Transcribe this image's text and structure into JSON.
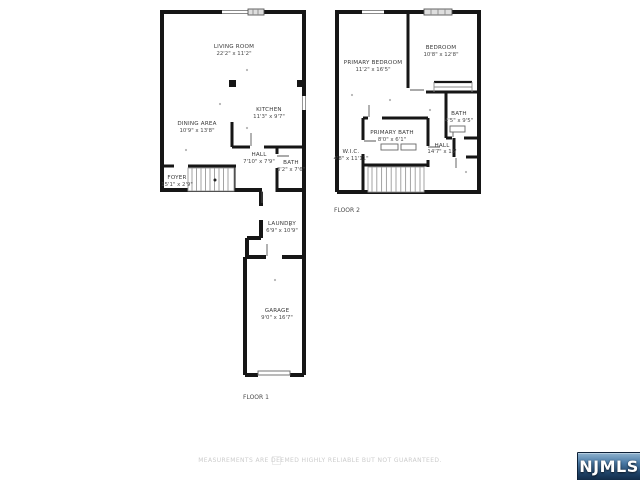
{
  "page": {
    "background": "#ffffff"
  },
  "colors": {
    "wall": "#161616",
    "window_fill": "#dedede",
    "label_text": "#3a3a3a",
    "disclaimer_text": "#cccccc",
    "logo_top": "#8fb3cf",
    "logo_bottom": "#122c49",
    "logo_text": "#ffffff"
  },
  "disclaimer": "MEASUREMENTS ARE DEEMED HIGHLY RELIABLE BUT NOT GUARANTEED.",
  "logo": {
    "text": "NJMLS"
  },
  "floor1": {
    "label": "FLOOR 1",
    "rooms": [
      {
        "name": "LIVING ROOM",
        "dims": "22'2\" x 11'2\""
      },
      {
        "name": "KITCHEN",
        "dims": "11'3\" x 9'7\""
      },
      {
        "name": "DINING AREA",
        "dims": "10'9\" x 13'8\""
      },
      {
        "name": "HALL",
        "dims": "7'10\" x 7'9\""
      },
      {
        "name": "BATH",
        "dims": "3'2\" x 7'6\""
      },
      {
        "name": "FOYER",
        "dims": "15'1\" x 2'9\""
      },
      {
        "name": "LAUNDRY",
        "dims": "6'9\" x 10'9\""
      },
      {
        "name": "GARAGE",
        "dims": "9'0\" x 16'7\""
      }
    ]
  },
  "floor2": {
    "label": "FLOOR 2",
    "rooms": [
      {
        "name": "PRIMARY BEDROOM",
        "dims": "11'2\" x 16'5\""
      },
      {
        "name": "BEDROOM",
        "dims": "10'8\" x 12'8\""
      },
      {
        "name": "BATH",
        "dims": "4'5\" x 9'5\""
      },
      {
        "name": "PRIMARY BATH",
        "dims": "8'0\" x 6'1\""
      },
      {
        "name": "W.I.C.",
        "dims": "4'8\" x 11'11\""
      },
      {
        "name": "HALL",
        "dims": "14'7\" x 15'"
      }
    ]
  }
}
